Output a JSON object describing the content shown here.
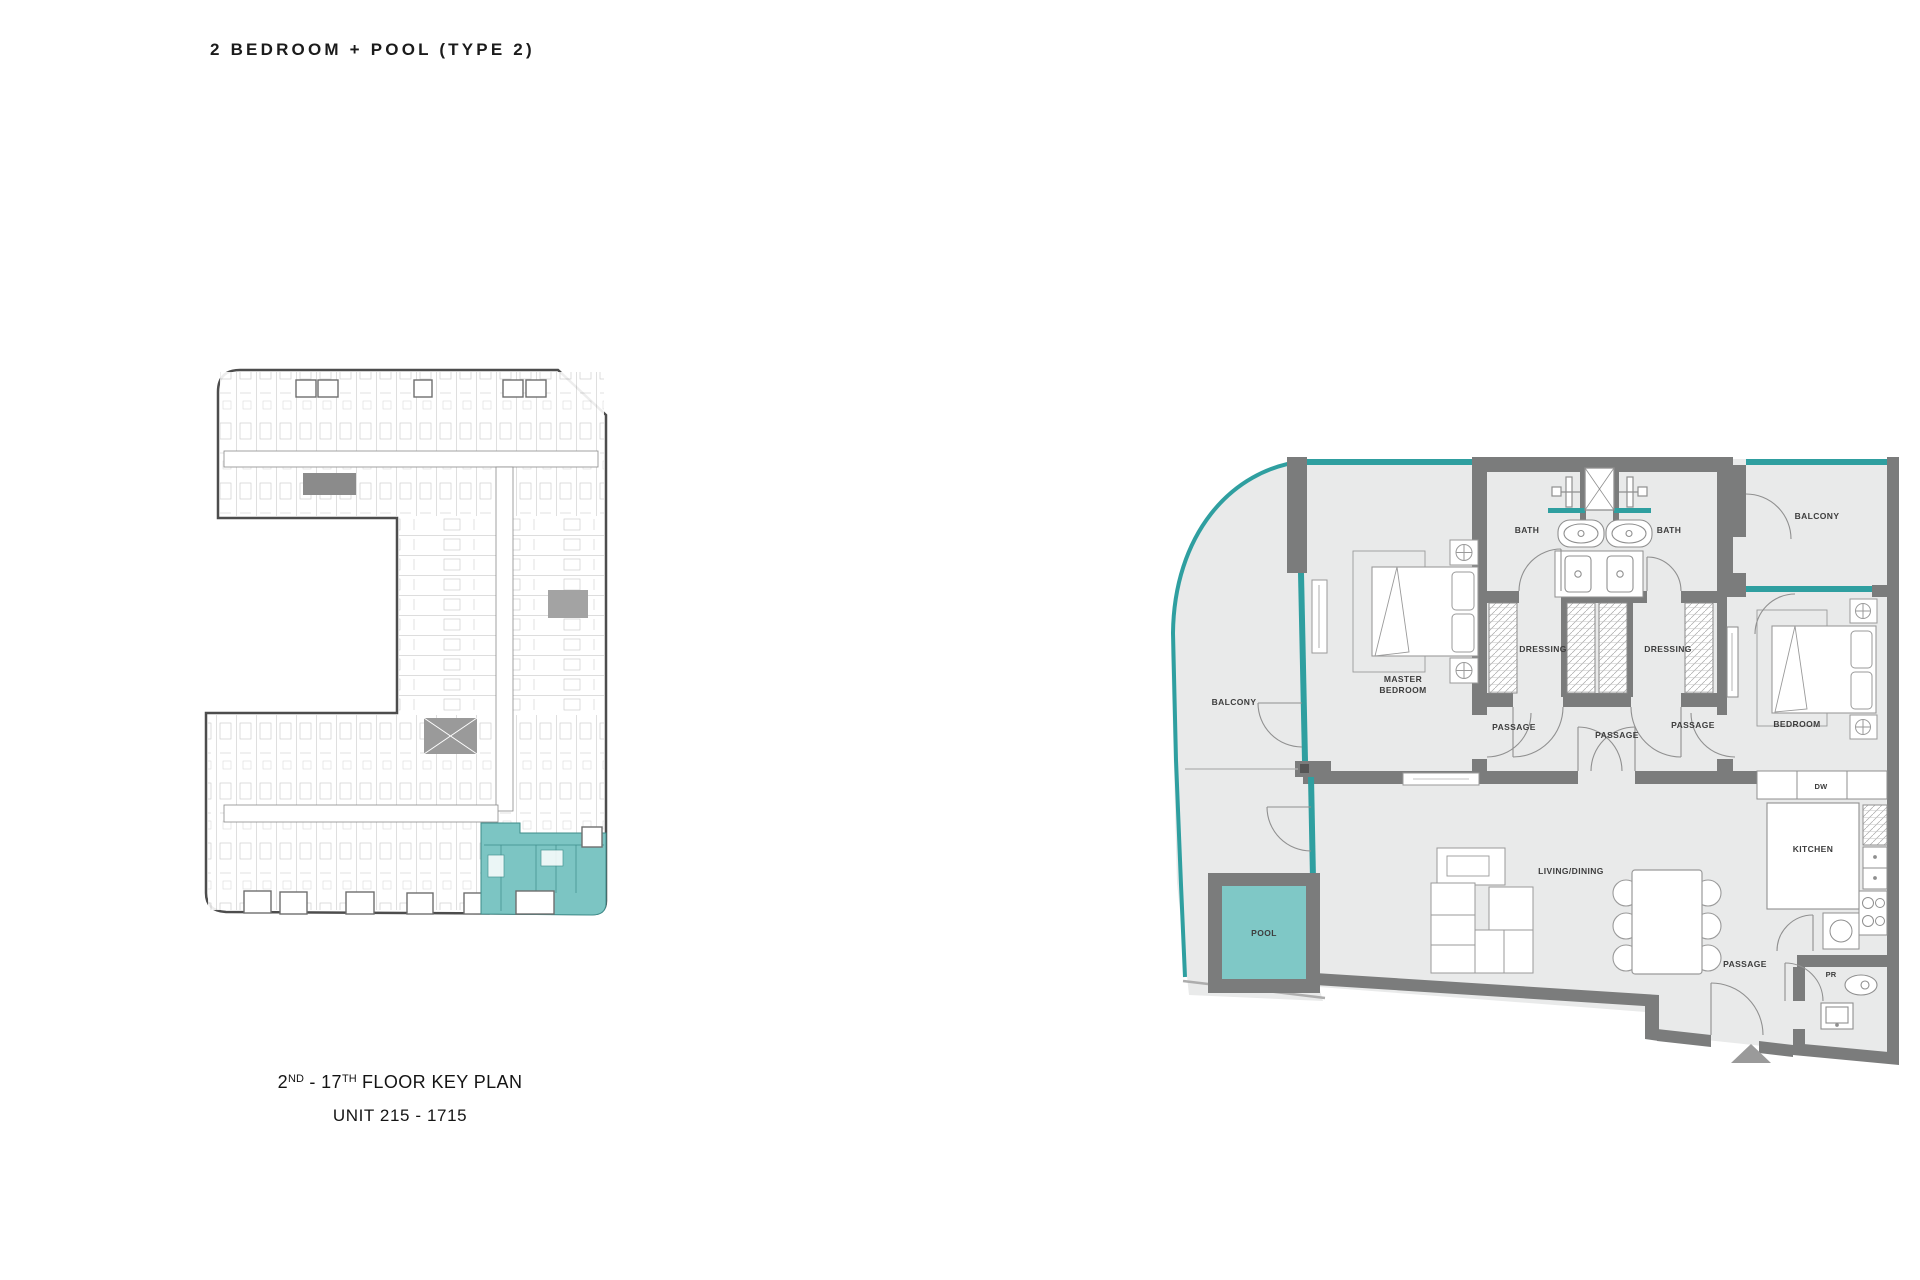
{
  "page": {
    "title": "2 BEDROOM + POOL (TYPE 2)"
  },
  "key_plan": {
    "caption": {
      "floor_num": "2",
      "floor_num_sup": "ND",
      "mid": " - 17",
      "floor_end_sup": "TH",
      "rest": " FLOOR KEY PLAN",
      "unit_range": "UNIT 215 - 1715"
    },
    "highlight_color": "#7cc5c3"
  },
  "unit_plan": {
    "rooms": {
      "bath_left": "BATH",
      "bath_right": "BATH",
      "balcony_right": "BALCONY",
      "balcony_left": "BALCONY",
      "dressing_left": "DRESSING",
      "dressing_right": "DRESSING",
      "master_line1": "MASTER",
      "master_line2": "BEDROOM",
      "bedroom": "BEDROOM",
      "passage_left": "PASSAGE",
      "passage_center": "PASSAGE",
      "passage_right": "PASSAGE",
      "passage_entry": "PASSAGE",
      "living_dining": "LIVING/DINING",
      "kitchen": "KITCHEN",
      "dishwasher": "DW",
      "pool": "POOL",
      "powder_room": "PR"
    },
    "colors": {
      "wall": "#7b7c7c",
      "floor": "#e9eaea",
      "glass": "#2f9fa0",
      "pool_water": "#7fc8c6"
    }
  }
}
